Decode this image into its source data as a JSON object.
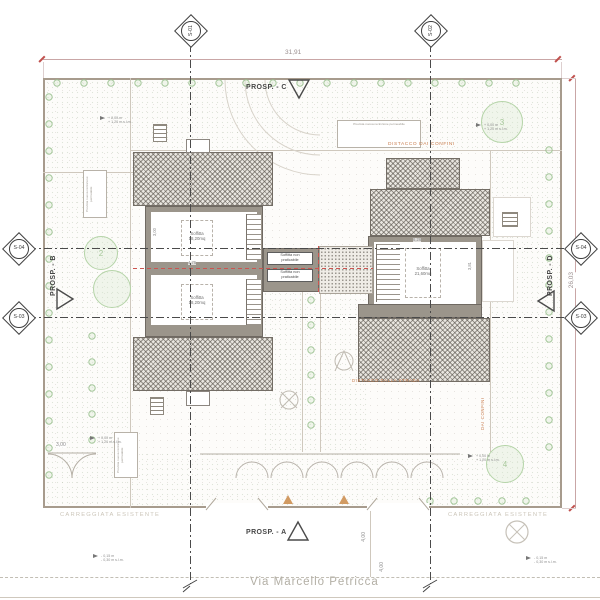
{
  "labels": {
    "prosp_a": "PROSP. - A",
    "prosp_b": "PROSP. - B",
    "prosp_c": "PROSP. - C",
    "prosp_d": "PROSP. - D"
  },
  "sections": {
    "s01": "S-01",
    "s02": "S-02",
    "s03": "S-03",
    "s04": "S-04"
  },
  "dimensions": {
    "site_width": "31,91",
    "site_depth": "26,03",
    "gate_width": "3,00",
    "road_setback": "4,00",
    "road_width": "4,00",
    "room_left_w": "4,75",
    "room_left_h": "3,00",
    "room_right_w": "6,26",
    "room_right_h": "3,81"
  },
  "rooms": {
    "left_upper": {
      "name": "Soffitta",
      "area": "18,20mq"
    },
    "left_lower": {
      "name": "Soffitta",
      "area": "18,20mq"
    },
    "right": {
      "name": "Soffitta",
      "area": "21,60mq"
    },
    "connector_top": {
      "line1": "Soffitta non",
      "line2": "praticabile"
    },
    "connector_bottom": {
      "line1": "Soffitta non",
      "line2": "praticabile"
    }
  },
  "annotations": {
    "distacco_confini": "DISTACCO DAI CONFINI",
    "distacco_strada": "DISTACCO DALLA STRADA",
    "dai_confini": "DAI CONFINI",
    "carreggiata": "CARREGGIATA ESISTENTE",
    "note_left": "Prevista nuova recinzione permeabile",
    "note_top": "Prevista nuova recinzione permeabile",
    "note_bottom": "Prevista nuova recinzione permeabile"
  },
  "street": {
    "name": "Via Marcello Petricca"
  },
  "levels": {
    "garden_top": "+ 0,00 m",
    "garden_bottom": "+ 1,20 m s.l.m.",
    "road_top": "- 0,15 m",
    "road_bottom": "- 0,30 m s.l.m."
  },
  "trees": {
    "top_right": "3",
    "left": "2",
    "bottom_right": "4"
  },
  "colors": {
    "wall": "#9b958b",
    "roof_edge": "#736d65",
    "accent_red": "#cc5450",
    "accent_orange": "#c97d4e",
    "green": "#b5d4a8",
    "dim_pink": "#c9a6a6"
  }
}
